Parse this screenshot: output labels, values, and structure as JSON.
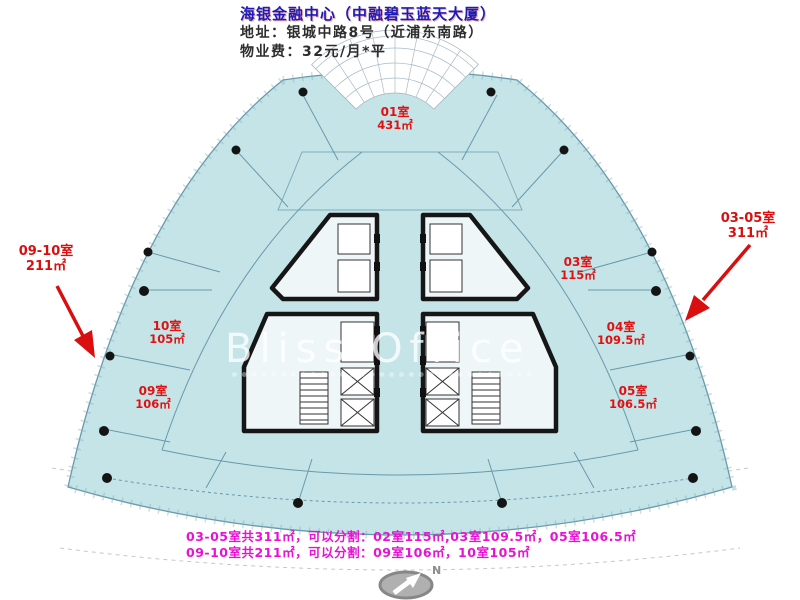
{
  "header": {
    "title": "海银金融中心（中融碧玉蓝天大厦）",
    "address": "地址：银城中路8号（近浦东南路）",
    "fee": "物业费：32元/月*平"
  },
  "rooms": [
    {
      "name": "01室",
      "area": "431㎡"
    },
    {
      "name": "03室",
      "area": "115㎡"
    },
    {
      "name": "04室",
      "area": "109.5㎡"
    },
    {
      "name": "05室",
      "area": "106.5㎡"
    },
    {
      "name": "09室",
      "area": "106㎡"
    },
    {
      "name": "10室",
      "area": "105㎡"
    }
  ],
  "callouts": [
    {
      "rooms": "09-10室",
      "area": "211㎡"
    },
    {
      "rooms": "03-05室",
      "area": "311㎡"
    }
  ],
  "footer": {
    "line1": "03-05室共311㎡，可以分割：02室115㎡,03室109.5㎡，05室106.5㎡",
    "line2": "09-10室共211㎡，可以分割：09室106㎡，10室105㎡"
  },
  "watermark": {
    "text": "Bliss Office"
  },
  "compass": {
    "label": "N"
  },
  "colors": {
    "floor_fill": "#c5e4e8",
    "plan_line": "#679aab",
    "core_wall": "#161616",
    "room_label": "#e01111",
    "arrow_red": "#d90f0f",
    "footer_magenta": "#e812d2",
    "title_blue": "#1c1cb8"
  }
}
